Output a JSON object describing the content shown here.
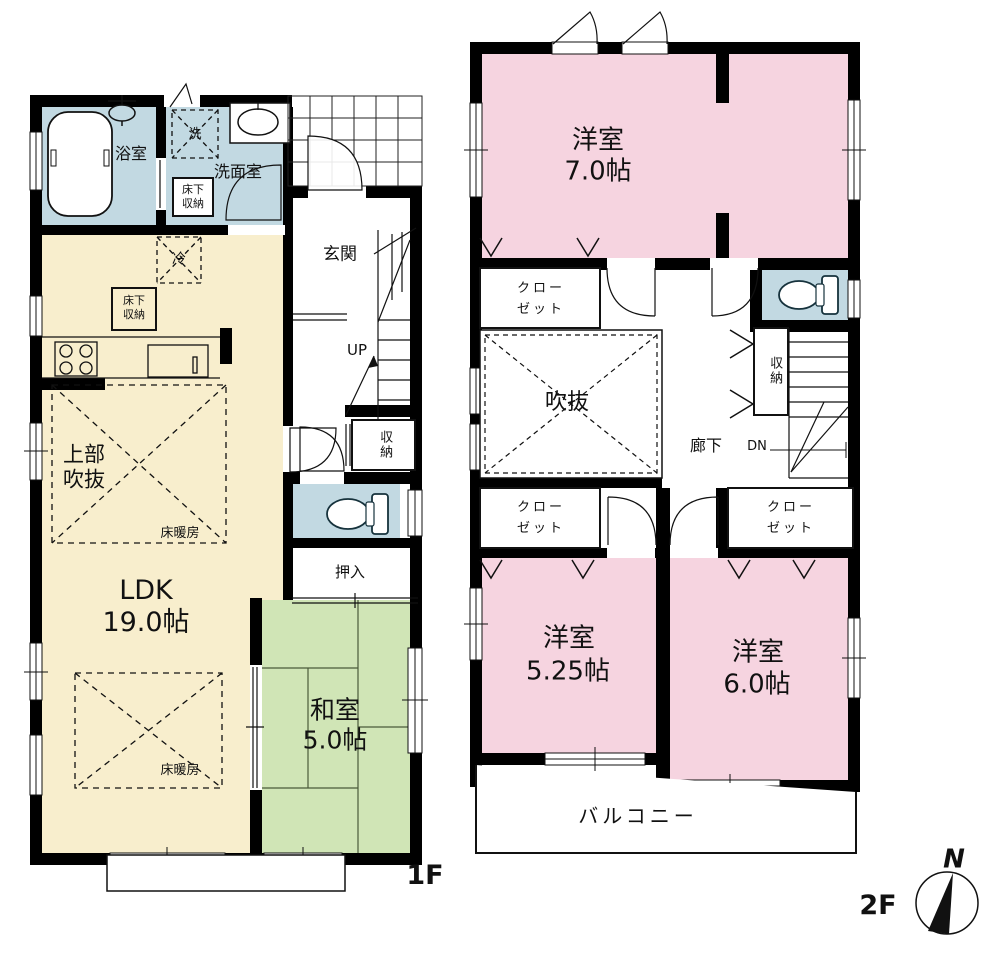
{
  "title": "間取り図",
  "colors": {
    "wall": "#000000",
    "room_cream": "#f8eecd",
    "room_blue": "#c2d9e2",
    "room_green": "#d0e5b6",
    "room_pink": "#f6d4e0",
    "line": "#1a1a1a"
  },
  "f1": {
    "floor_label": "1F",
    "bath": "浴室",
    "washer": "洗",
    "washroom": "洗面室",
    "uf1a": "床下",
    "uf1b": "収納",
    "entrance": "玄関",
    "fridge": "冷",
    "uf2a": "床下",
    "uf2b": "収納",
    "up": "UP",
    "storage": "収納",
    "void_a": "上部",
    "void_b": "吹抜",
    "heating1": "床暖房",
    "ldk": "LDK",
    "ldk_size": "19.0帖",
    "heating2": "床暖房",
    "oshiire": "押入",
    "washitsu": "和室",
    "washitsu_size": "5.0帖"
  },
  "f2": {
    "floor_label": "2F",
    "room1": "洋室",
    "room1_size": "7.0帖",
    "closet_a1": "クロー",
    "closet_a2": "ゼット",
    "void": "吹抜",
    "hall": "廊下",
    "dn": "DN",
    "storage": "収納",
    "closet_b1": "クロー",
    "closet_b2": "ゼット",
    "closet_c1": "クロー",
    "closet_c2": "ゼット",
    "room2": "洋室",
    "room2_size": "5.25帖",
    "room3": "洋室",
    "room3_size": "6.0帖",
    "balcony": "バルコニー"
  },
  "compass": {
    "north": "N"
  }
}
